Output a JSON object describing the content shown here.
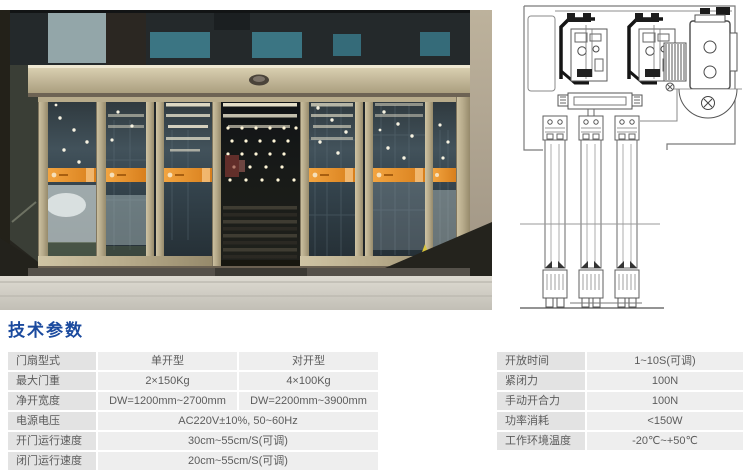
{
  "section": {
    "title": "技术参数"
  },
  "colors": {
    "title_blue": "#1b4a9e",
    "table_label_bg": "#e3e3e3",
    "table_value_bg": "#eeeeee",
    "table_text": "#5c5c5c",
    "stripe_orange": "#e08a2e",
    "frame_champagne": "#b9ad8d",
    "diagram_line": "#555555"
  },
  "left_table": {
    "rows": [
      {
        "label": "门扇型式",
        "v1": "单开型",
        "v2": "对开型"
      },
      {
        "label": "最大门重",
        "v1": "2×150Kg",
        "v2": "4×100Kg"
      },
      {
        "label": "净开宽度",
        "v1": "DW=1200mm~2700mm",
        "v2": "DW=2200mm~3900mm"
      },
      {
        "label": "电源电压",
        "v": "AC220V±10%, 50~60Hz"
      },
      {
        "label": "开门运行速度",
        "v": "30cm~55cm/S(可调)"
      },
      {
        "label": "闭门运行速度",
        "v": "20cm~55cm/S(可调)"
      }
    ]
  },
  "right_table": {
    "rows": [
      {
        "label": "开放时间",
        "v": "1~10S(可调)"
      },
      {
        "label": "紧闭力",
        "v": "100N"
      },
      {
        "label": "手动开合力",
        "v": "100N"
      },
      {
        "label": "功率消耗",
        "v": "<150W"
      },
      {
        "label": "工作环境温度",
        "v": "-20℃~+50℃"
      }
    ]
  },
  "images": {
    "photo": "entrance-photo",
    "diagram": "door-mechanism-cross-section"
  }
}
